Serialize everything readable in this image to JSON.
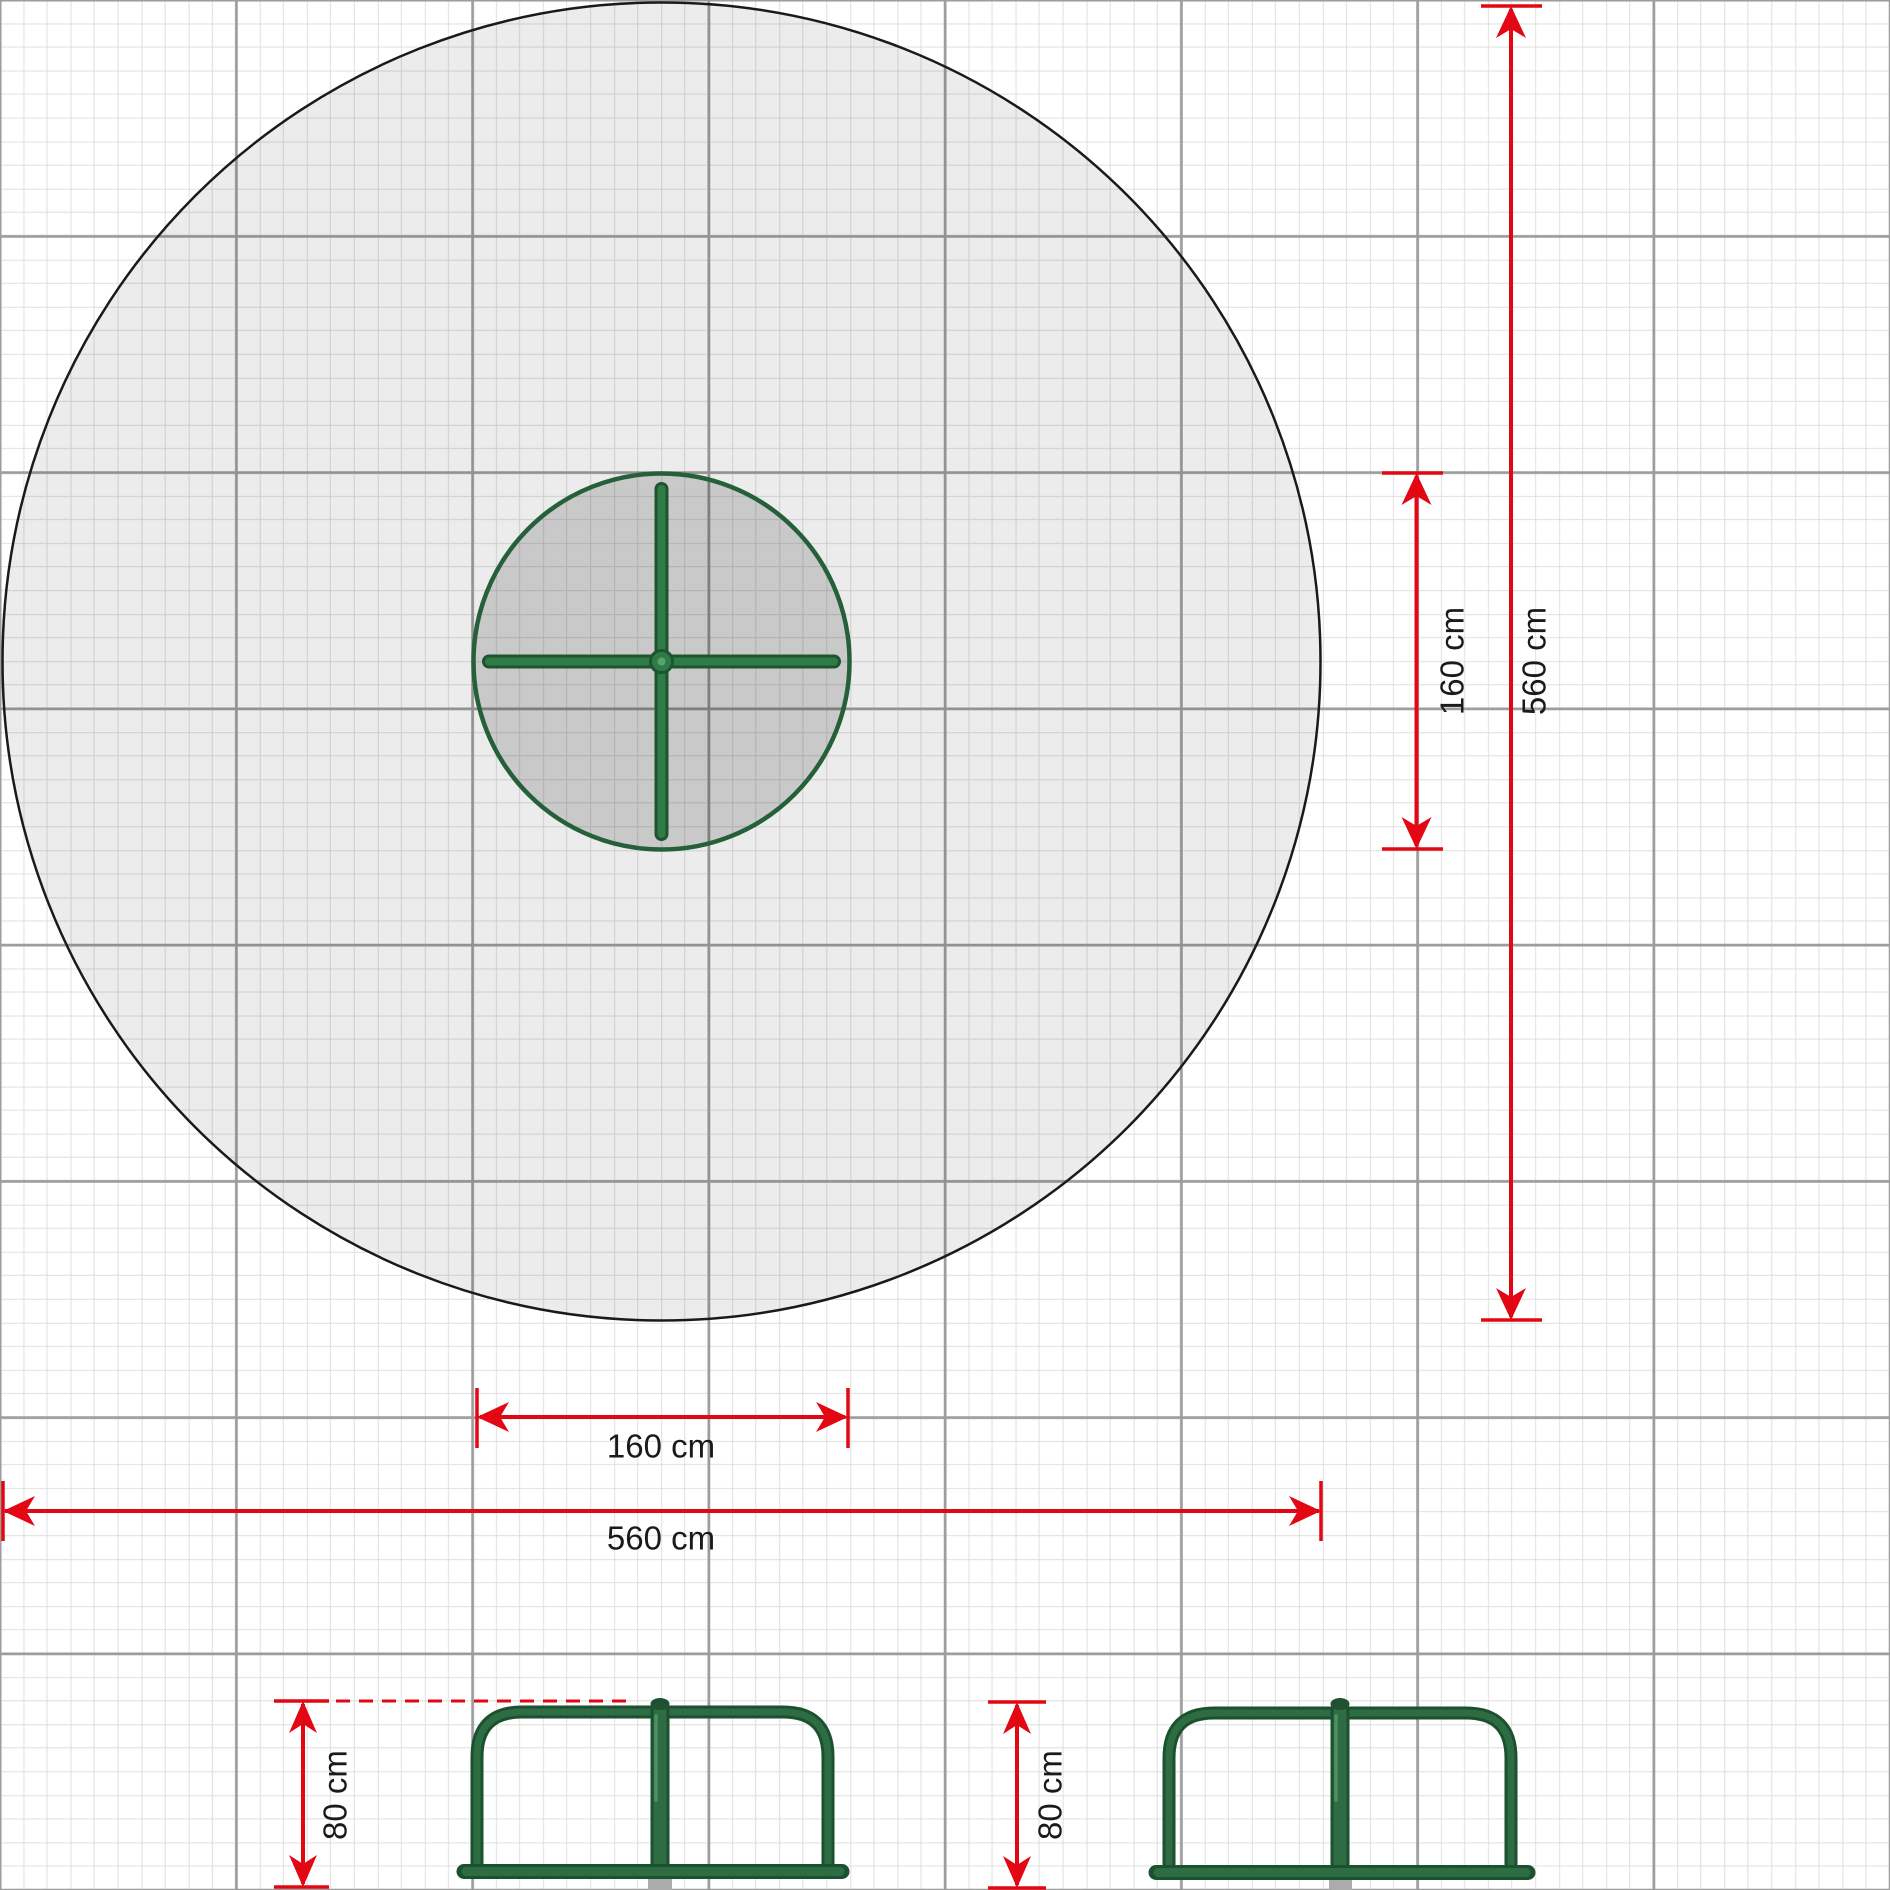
{
  "drawing": {
    "title_semantics": "carousel plan with safety zone (top view) and two side elevations",
    "top_view": {
      "safety_zone_diameter_label": "560 cm",
      "equipment_diameter_label": "160 cm"
    },
    "side_views": {
      "handrail_height_label": "80 cm"
    }
  },
  "dimensions": [
    {
      "id": "equipment-width",
      "label": "160 cm",
      "orientation": "horizontal"
    },
    {
      "id": "zone-width",
      "label": "560 cm",
      "orientation": "horizontal"
    },
    {
      "id": "equipment-height",
      "label": "160 cm",
      "orientation": "vertical"
    },
    {
      "id": "zone-height",
      "label": "560 cm",
      "orientation": "vertical"
    },
    {
      "id": "left-rail-height",
      "label": "80 cm",
      "orientation": "vertical"
    },
    {
      "id": "right-rail-height",
      "label": "80 cm",
      "orientation": "vertical"
    }
  ],
  "colors": {
    "dimension_red": "#e30613",
    "frame_green_dark": "#1c5130",
    "frame_green": "#2e6d43",
    "cross_green": "#2f7c47",
    "zone_outline": "#1a1a1a",
    "zone_fill": "rgba(40,40,40,0.085)",
    "equipment_fill": "rgba(30,30,30,0.17)",
    "grid_major": "#9d9d9d",
    "grid_minor": "#dcdcdc",
    "footing_gray": "#ababab",
    "text": "#1a1a1a"
  }
}
